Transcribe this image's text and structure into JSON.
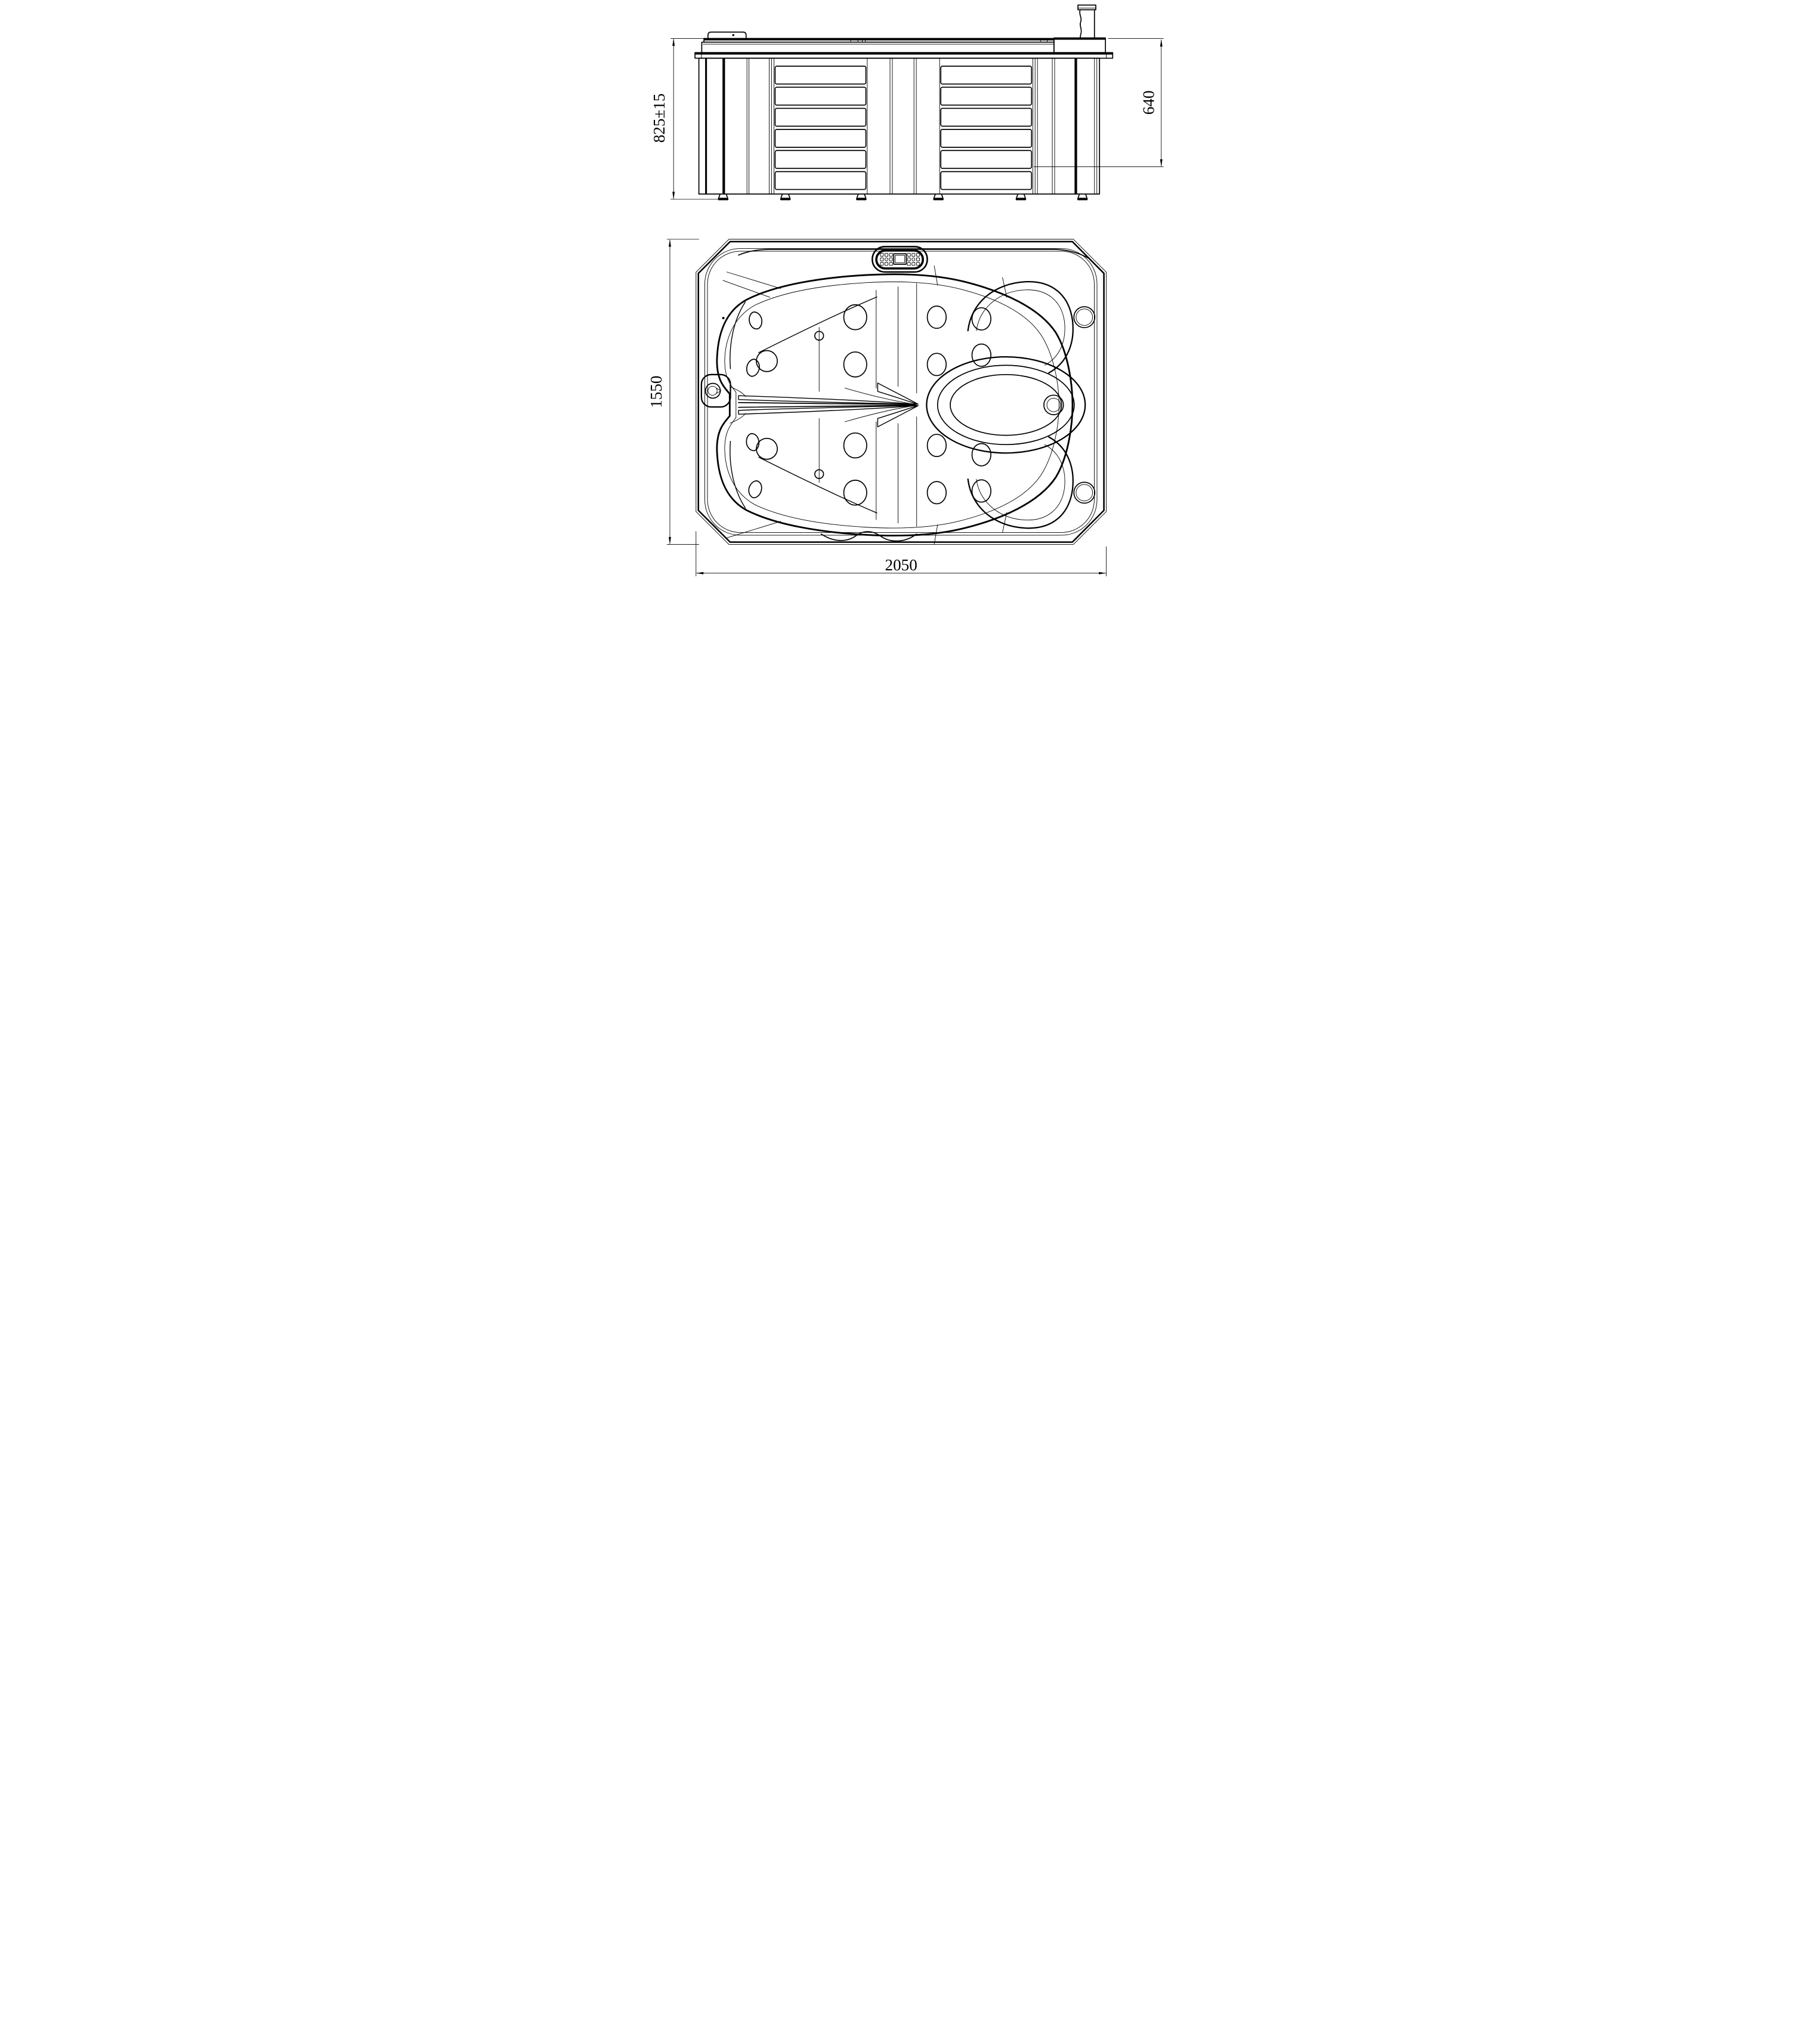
{
  "drawing": {
    "subject": "spa-hot-tub-two-view-dimensional-drawing",
    "background": "#ffffff",
    "line_color": "#000000",
    "views": {
      "side": {
        "label": "side elevation"
      },
      "plan": {
        "label": "plan view"
      }
    },
    "dimensions": {
      "overall_height": {
        "text": "825±15",
        "orientation": "vertical",
        "location": "side-view-left"
      },
      "shell_depth": {
        "text": "640",
        "orientation": "vertical",
        "location": "side-view-right"
      },
      "overall_width": {
        "text": "1550",
        "orientation": "vertical",
        "location": "plan-view-left"
      },
      "overall_length": {
        "text": "2050",
        "orientation": "horizontal",
        "location": "plan-view-bottom"
      }
    },
    "features": {
      "control_panel": "keypad with display",
      "skirt": "cabinet with louvered panels and feet",
      "seats": "two lounge seats, two corner seats",
      "footwell": "oval footwell with drain",
      "cup_holders": 2
    }
  }
}
